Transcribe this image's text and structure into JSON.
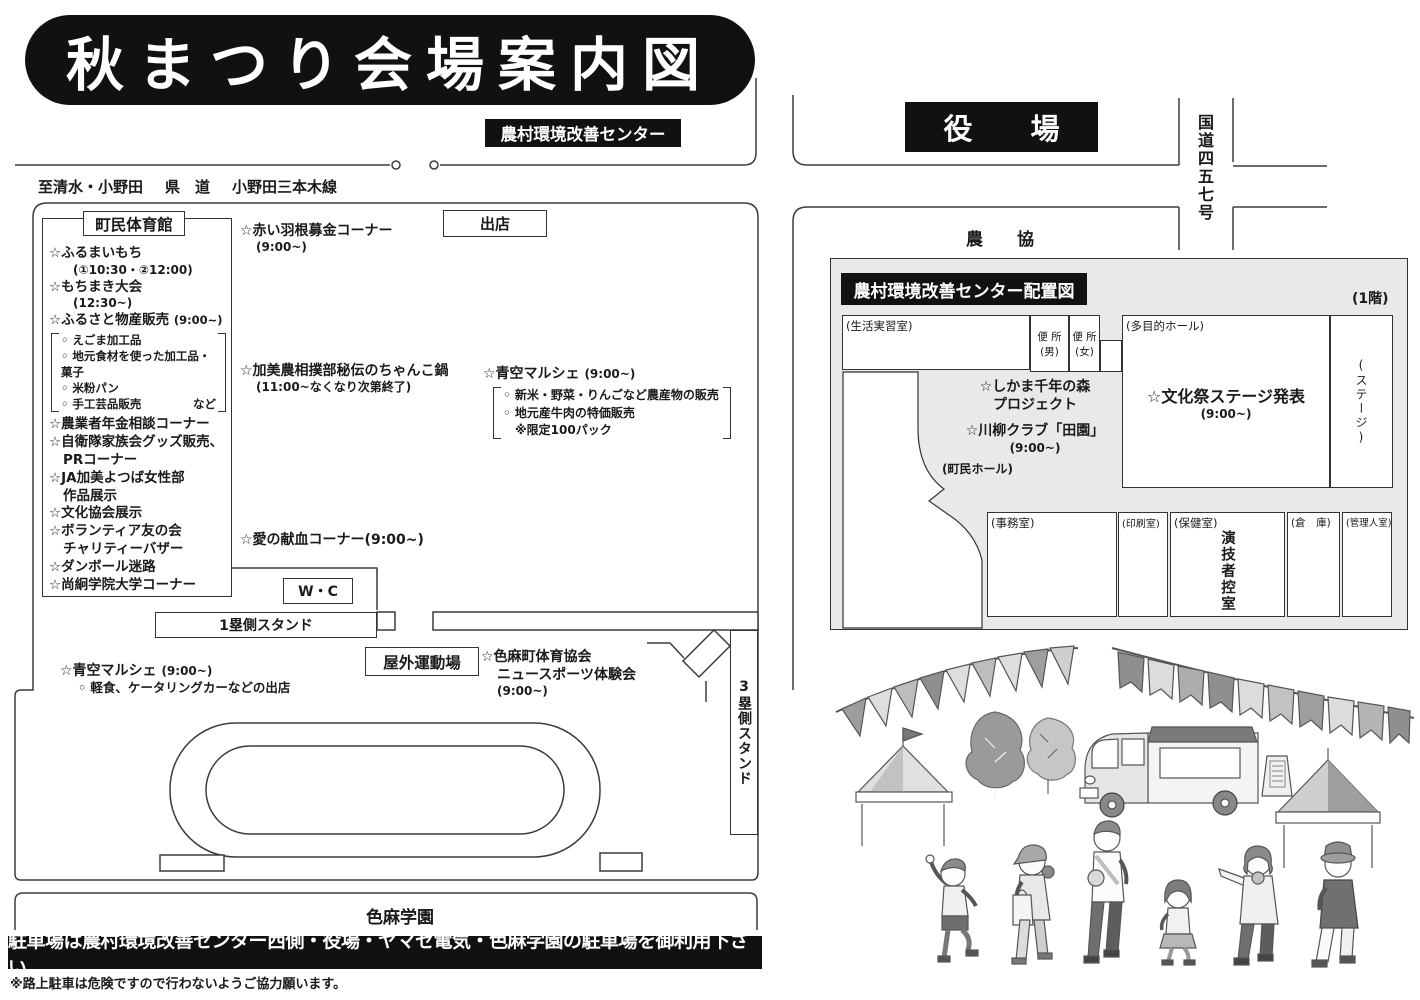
{
  "title": "秋まつり会場案内図",
  "top": {
    "center_label": "農村環境改善センター",
    "road_to": "至清水・小野田",
    "road_kind": "県　道",
    "road_name": "小野田三本木線"
  },
  "right_map": {
    "yakuba": "役　　場",
    "kokudou": "国道四五七号",
    "noukyou": "農　　協"
  },
  "gym": {
    "name": "町民体育館",
    "i1": "☆ふるまいもち",
    "i1t": "(①10:30・②12:00)",
    "i2": "☆もちまき大会",
    "i2t": "(12:30~)",
    "i3": "☆ふるさと物産販売",
    "i3t": "(9:00~)",
    "b1": "◦ えごま加工品",
    "b2": "◦ 地元食材を使った加工品・菓子",
    "b3": "◦ 米粉パン",
    "b4": "◦ 手工芸品販売",
    "b4x": "など",
    "i4": "☆農業者年金相談コーナー",
    "i5a": "☆自衛隊家族会グッズ販売、",
    "i5b": "PRコーナー",
    "i6a": "☆JA加美よつば女性部",
    "i6b": "作品展示",
    "i7": "☆文化協会展示",
    "i8a": "☆ボランティア友の会",
    "i8b": "チャリティーバザー",
    "i9": "☆ダンボール迷路",
    "i10": "☆尚絅学院大学コーナー"
  },
  "spots": {
    "shukuten": "出店",
    "akai": "☆赤い羽根募金コーナー",
    "akai_t": "(9:00~)",
    "chanko": "☆加美農相撲部秘伝のちゃんこ鍋",
    "chanko_t": "(11:00~なくなり次第終了)",
    "marche": "☆青空マルシェ",
    "marche_t": "(9:00~)",
    "marche_b1": "◦ 新米・野菜・りんごなど農産物の販売",
    "marche_b2": "◦ 地元産牛肉の特価販売",
    "marche_b3": "※限定100パック",
    "kenketsu": "☆愛の献血コーナー(9:00~)",
    "wc": "W・C",
    "stand1": "1塁側スタンド",
    "stand3": "3塁側スタンド",
    "field": "屋外運動場",
    "sports_a": "☆色麻町体育協会",
    "sports_b": "ニュースポーツ体験会",
    "sports_t": "(9:00~)",
    "marche2": "☆青空マルシェ",
    "marche2_t": "(9:00~)",
    "marche2_b": "◦ 軽食、ケータリングカーなどの出店",
    "gakuen": "色麻学園"
  },
  "center_map": {
    "title": "農村環境改善センター配置図",
    "floor": "(1階)",
    "rooms": {
      "seikatsu": "(生活実習室)",
      "benjo_m1": "便 所",
      "benjo_m2": "(男)",
      "benjo_f1": "便 所",
      "benjo_f2": "(女)",
      "hall": "(多目的ホール)",
      "stage": "(ステージ)",
      "chomin": "(町民ホール)",
      "jimu": "(事務室)",
      "insatsu": "(印刷室)",
      "hoken": "(保健室)",
      "hikae": "演技者控室",
      "souko": "(倉　庫)",
      "kanri": "(管理人室)"
    },
    "events": {
      "shikama_a": "☆しかま千年の森",
      "shikama_b": "プロジェクト",
      "senryu": "☆川柳クラブ「田園」",
      "senryu_t": "(9:00~)",
      "bunka": "☆文化祭ステージ発表",
      "bunka_t": "(9:00~)"
    }
  },
  "notice": {
    "banner": "駐車場は農村環境改善センター西側・役場・ヤマセ電気・色麻学園の駐車場を御利用下さい",
    "note": "※路上駐車は危険ですので行わないようご協力願います。"
  },
  "colors": {
    "ink": "#111111",
    "line": "#3c3c3c",
    "panel": "#e9e9e9"
  }
}
